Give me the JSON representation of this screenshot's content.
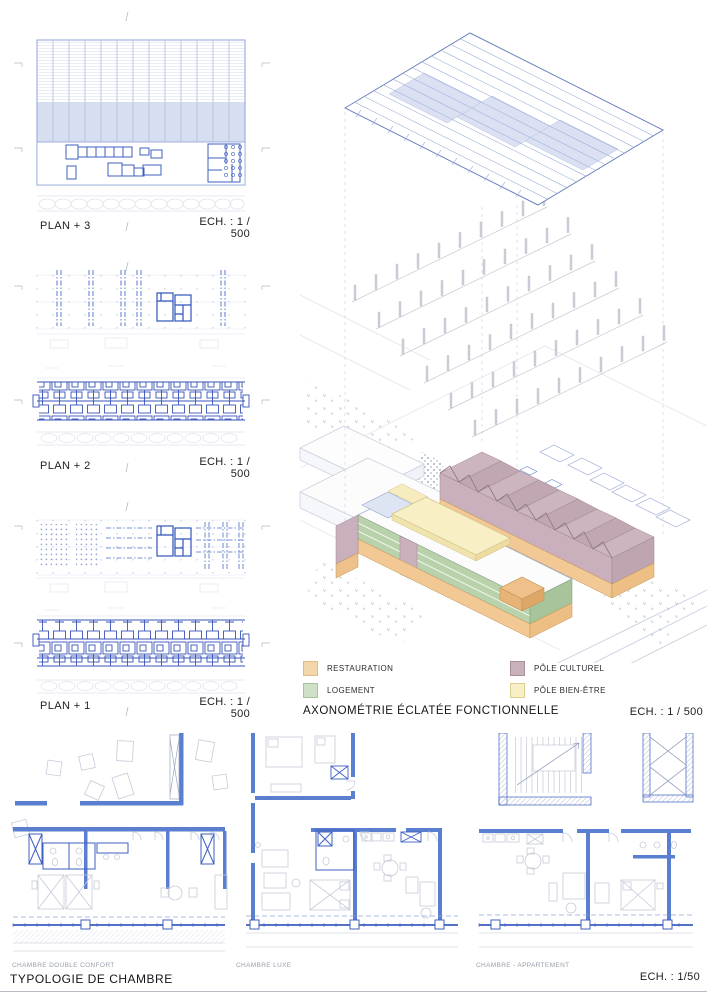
{
  "plans": [
    {
      "label": "PLAN + 3",
      "scale": "ECH. : 1 / 500"
    },
    {
      "label": "PLAN + 2",
      "scale": "ECH. : 1 / 500"
    },
    {
      "label": "PLAN + 1",
      "scale": "ECH. : 1 / 500"
    }
  ],
  "axonometric": {
    "title": "AXONOMÉTRIE ÉCLATÉE FONCTIONNELLE",
    "scale": "ECH. : 1 / 500",
    "legend": [
      {
        "label": "RESTAURATION",
        "color": "#f3d6a9",
        "swatch_style": "background:#f3d6a9;border:1px solid #ddbd85;"
      },
      {
        "label": "LOGEMENT",
        "color": "#cfe0c6",
        "swatch_style": "background:#cfe0c6;border:1px solid #a9c29b;"
      },
      {
        "label": "PÔLE CULTUREL",
        "color": "#c8b1bb",
        "swatch_style": "background:#c8b1bb;border:1px solid #a98f9b;"
      },
      {
        "label": "PÔLE BIEN-ÊTRE",
        "color": "#f8efc6",
        "swatch_style": "background:#f8efc6;border:1px solid #dccf92;"
      }
    ]
  },
  "typologies": {
    "title": "TYPOLOGIE DE CHAMBRE",
    "scale": "ECH. : 1/50",
    "items": [
      {
        "label": "CHAMBRE DOUBLE CONFORT"
      },
      {
        "label": "CHAMBRE LUXE"
      },
      {
        "label": "CHAMBRE - APPARTEMENT"
      }
    ]
  },
  "palette": {
    "plan_blue": "#3c5fc1",
    "wall_blue": "#5b7fd0",
    "pale_plan_fill": "#d6def2",
    "roof_shade": "#dbe1f3",
    "context_grey": "#c6c9d2",
    "restauration": "#f2c894",
    "logement": "#b9d2ac",
    "pole_culturel": "#cdb6c0",
    "pole_bien_etre": "#f8efc4"
  }
}
